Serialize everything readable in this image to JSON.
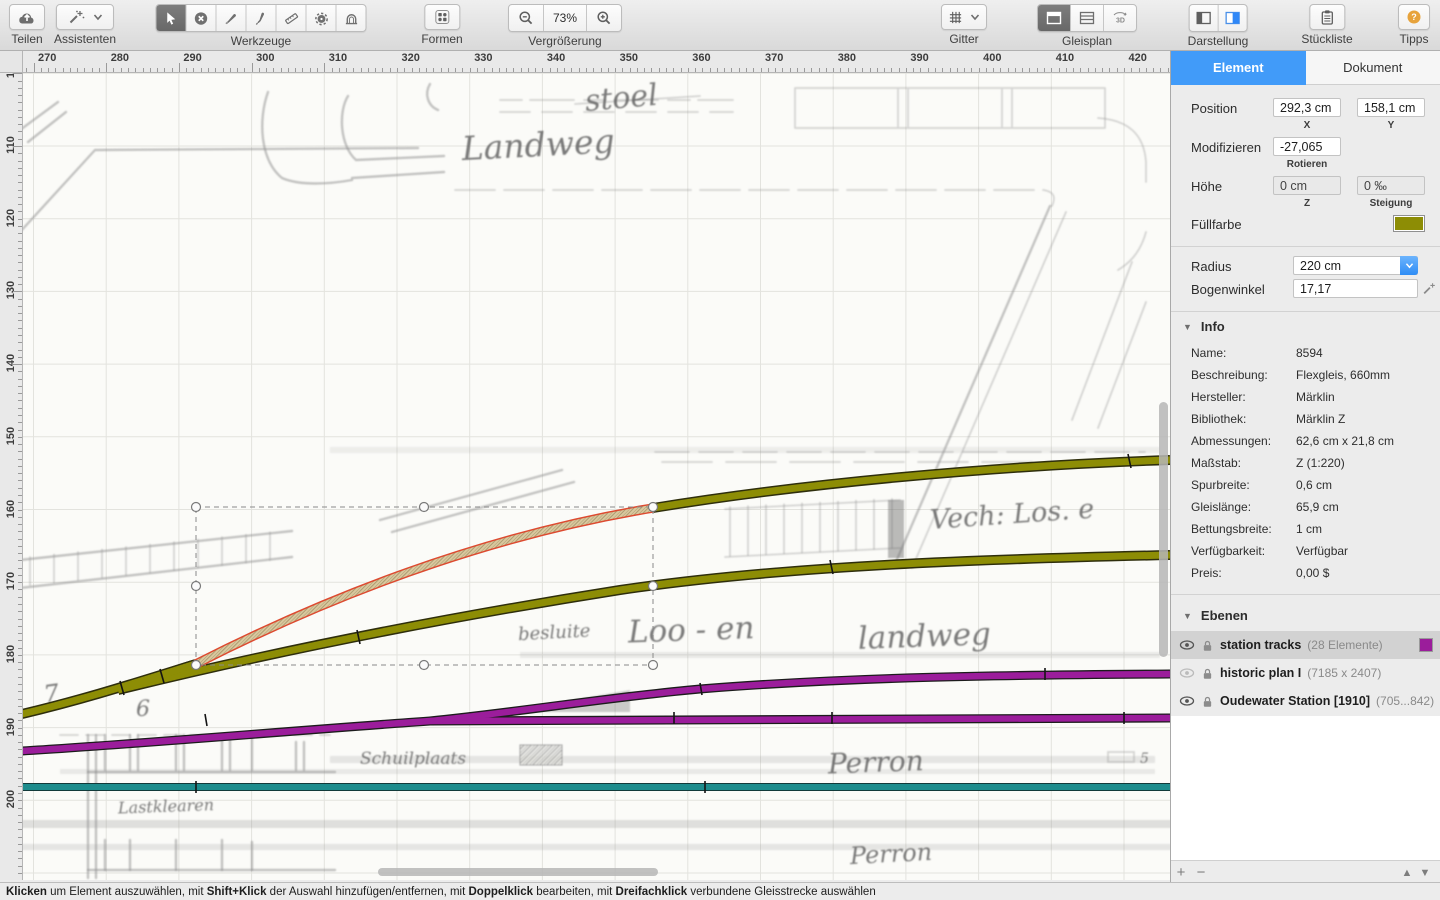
{
  "toolbar": {
    "teilen": {
      "label": "Teilen"
    },
    "assistenten": {
      "label": "Assistenten"
    },
    "werkzeuge": {
      "label": "Werkzeuge"
    },
    "formen": {
      "label": "Formen"
    },
    "vergroesserung": {
      "label": "Vergrößerung",
      "zoom_value": "73%"
    },
    "gitter": {
      "label": "Gitter"
    },
    "gleisplan": {
      "label": "Gleisplan",
      "threed": "3D"
    },
    "darstellung": {
      "label": "Darstellung"
    },
    "stueckliste": {
      "label": "Stückliste"
    },
    "tipps": {
      "label": "Tipps",
      "glyph": "?"
    }
  },
  "rulers": {
    "top_labels": [
      "270",
      "280",
      "290",
      "300",
      "310",
      "320",
      "330",
      "340",
      "350",
      "360",
      "370",
      "380",
      "390",
      "400",
      "410",
      "420"
    ],
    "left_labels": [
      "110",
      "120",
      "130",
      "140",
      "150",
      "160",
      "170",
      "180",
      "190",
      "200"
    ],
    "left_partial": "10"
  },
  "canvas": {
    "colors": {
      "olive": "#8d8d05",
      "purple": "#9b1d9b",
      "teal": "#1d8c8c",
      "selection_red": "#dd4a30"
    },
    "annotations": {
      "stoel": "stoel",
      "landweg_top": "Landweg",
      "vech": "Vech: Los. e",
      "besluite": "besluite",
      "loo_en": "Loo - en",
      "landweg_bottom": "landweg",
      "schuilplaats": "Schuilplaats",
      "perron_upper": "Perron",
      "perron_lower": "Perron",
      "lastklearen": "Lastklearen",
      "num7": "7",
      "num6": "6",
      "num5": "5"
    }
  },
  "panel": {
    "tabs": {
      "element": "Element",
      "dokument": "Dokument"
    },
    "position": {
      "label": "Position",
      "x_value": "292,3 cm",
      "x_label": "X",
      "y_value": "158,1 cm",
      "y_label": "Y"
    },
    "modifizieren": {
      "label": "Modifizieren",
      "rotate_value": "-27,065",
      "rotate_label": "Rotieren"
    },
    "hoehe": {
      "label": "Höhe",
      "z_value": "0 cm",
      "z_label": "Z",
      "slope_value": "0 ‰",
      "slope_label": "Steigung"
    },
    "fuellfarbe": {
      "label": "Füllfarbe"
    },
    "radius": {
      "label": "Radius",
      "value": "220 cm"
    },
    "bogenwinkel": {
      "label": "Bogenwinkel",
      "value": "17,17"
    },
    "info": {
      "title": "Info",
      "rows": [
        {
          "label": "Name:",
          "value": "8594"
        },
        {
          "label": "Beschreibung:",
          "value": "Flexgleis, 660mm"
        },
        {
          "label": "Hersteller:",
          "value": "Märklin"
        },
        {
          "label": "Bibliothek:",
          "value": "Märklin Z"
        },
        {
          "label": "Abmessungen:",
          "value": "62,6 cm x 21,8 cm"
        },
        {
          "label": "Maßstab:",
          "value": "Z  (1:220)"
        },
        {
          "label": "Spurbreite:",
          "value": "0,6 cm"
        },
        {
          "label": "Gleislänge:",
          "value": "65,9 cm"
        },
        {
          "label": "Bettungsbreite:",
          "value": "1 cm"
        },
        {
          "label": "Verfügbarkeit:",
          "value": "Verfügbar"
        },
        {
          "label": "Preis:",
          "value": "0,00 $"
        }
      ]
    },
    "ebenen": {
      "title": "Ebenen",
      "layers": [
        {
          "name": "station tracks",
          "detail": "(28 Elemente)"
        },
        {
          "name": "historic plan I",
          "detail": "(7185 x 2407)"
        },
        {
          "name": "Oudewater Station [1910]",
          "detail": "(705...842)"
        }
      ]
    },
    "bottombar": {
      "add": "+",
      "remove": "−",
      "up": "▲",
      "down": "▼"
    }
  },
  "statusbar": {
    "p1": "Klicken",
    "p2": " um Element auszuwählen, mit ",
    "p3": "Shift+Klick",
    "p4": " der Auswahl hinzufügen/entfernen, mit ",
    "p5": "Doppelklick",
    "p6": " bearbeiten, mit ",
    "p7": "Dreifachklick",
    "p8": " verbundene Gleisstrecke auswählen"
  }
}
